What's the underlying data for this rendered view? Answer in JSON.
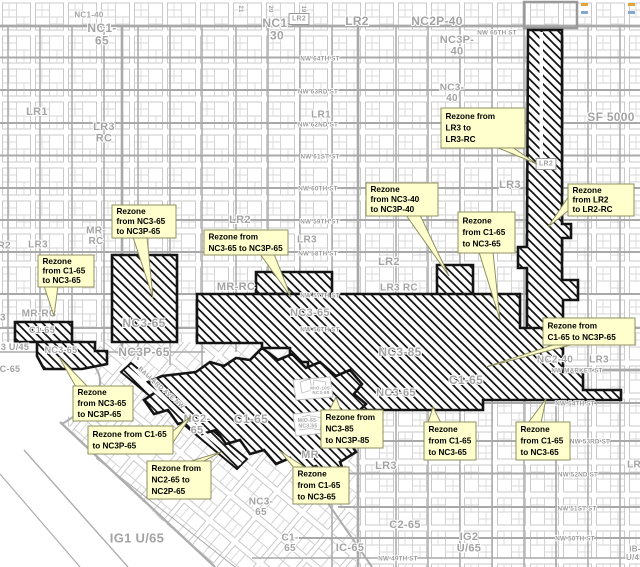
{
  "map": {
    "width": 640,
    "height": 567,
    "colors": {
      "background": "#ffffff",
      "parcel_line": "#cbcbcb",
      "street_line": "#a9a9a9",
      "zone_label": "#a3a3a3",
      "street_label": "#9b9b9b",
      "hatch_border": "#141414",
      "hatch_line": "#141414",
      "callout_bg": "#ffffcd",
      "callout_border": "#8f8f62",
      "callout_text": "#000000"
    }
  },
  "zone_labels": [
    {
      "text": "NC1-40",
      "x": 89,
      "y": 15,
      "size": 8
    },
    {
      "text": "NC1-\n65",
      "x": 102,
      "y": 28,
      "size": 12
    },
    {
      "text": "NC1-\n30",
      "x": 277,
      "y": 23,
      "size": 12
    },
    {
      "text": "LR2",
      "x": 299,
      "y": 19,
      "size": 7,
      "boxed": true
    },
    {
      "text": "LR2",
      "x": 357,
      "y": 21,
      "size": 12
    },
    {
      "text": "NC2P-40",
      "x": 437,
      "y": 21,
      "size": 12
    },
    {
      "text": "NC3P-\n40",
      "x": 457,
      "y": 40,
      "size": 11
    },
    {
      "text": "NC3-\n40",
      "x": 452,
      "y": 88,
      "size": 10
    },
    {
      "text": "LR1",
      "x": 37,
      "y": 112,
      "size": 11
    },
    {
      "text": "LR3\nRC",
      "x": 104,
      "y": 127,
      "size": 11
    },
    {
      "text": "LR1",
      "x": 321,
      "y": 115,
      "size": 10
    },
    {
      "text": "SF 5000",
      "x": 611,
      "y": 117,
      "size": 12
    },
    {
      "text": "LR2",
      "x": 240,
      "y": 220,
      "size": 11
    },
    {
      "text": "MR-\nRC",
      "x": 96,
      "y": 231,
      "size": 10
    },
    {
      "text": "LR3",
      "x": 38,
      "y": 245,
      "size": 10
    },
    {
      "text": "LR2",
      "x": 1,
      "y": 246,
      "size": 10
    },
    {
      "text": "LR3",
      "x": 307,
      "y": 240,
      "size": 10
    },
    {
      "text": "LR2",
      "x": 546,
      "y": 164,
      "size": 7,
      "boxed": true
    },
    {
      "text": "LR3",
      "x": 510,
      "y": 185,
      "size": 11
    },
    {
      "text": "LR2",
      "x": 389,
      "y": 262,
      "size": 11
    },
    {
      "text": "LR3 RC",
      "x": 399,
      "y": 288,
      "size": 10
    },
    {
      "text": "MR-RC",
      "x": 236,
      "y": 287,
      "size": 11
    },
    {
      "text": "MR-RC",
      "x": 39,
      "y": 314,
      "size": 10
    },
    {
      "text": "LR3",
      "x": -4,
      "y": 318,
      "size": 10
    },
    {
      "text": "C1-65",
      "x": 42,
      "y": 330,
      "size": 9
    },
    {
      "text": "3 U/45",
      "x": 15,
      "y": 347,
      "size": 9
    },
    {
      "text": "NC3-65",
      "x": 61,
      "y": 350,
      "size": 9
    },
    {
      "text": "C-65",
      "x": 10,
      "y": 369,
      "size": 9
    },
    {
      "text": "NC3-65",
      "x": 144,
      "y": 323,
      "size": 12
    },
    {
      "text": "NC3P-65",
      "x": 144,
      "y": 352,
      "size": 12
    },
    {
      "text": "NC3-65",
      "x": 310,
      "y": 313,
      "size": 11
    },
    {
      "text": "NC3-85",
      "x": 400,
      "y": 352,
      "size": 12
    },
    {
      "text": "NC3-65",
      "x": 396,
      "y": 393,
      "size": 11
    },
    {
      "text": "C1-65",
      "x": 466,
      "y": 380,
      "size": 12
    },
    {
      "text": "NC2-\n65",
      "x": 197,
      "y": 419,
      "size": 11
    },
    {
      "text": "C1-65",
      "x": 251,
      "y": 419,
      "size": 12
    },
    {
      "text": "MR",
      "x": 310,
      "y": 455,
      "size": 11
    },
    {
      "text": "NC2-40",
      "x": 555,
      "y": 360,
      "size": 10
    },
    {
      "text": "LR3",
      "x": 599,
      "y": 360,
      "size": 10
    },
    {
      "text": "LR3",
      "x": 386,
      "y": 466,
      "size": 11
    },
    {
      "text": "LR3",
      "x": 637,
      "y": 465,
      "size": 10
    },
    {
      "text": "NC3-\n65",
      "x": 261,
      "y": 502,
      "size": 10
    },
    {
      "text": "C1-\n65",
      "x": 290,
      "y": 538,
      "size": 10
    },
    {
      "text": "C2-65",
      "x": 405,
      "y": 525,
      "size": 11
    },
    {
      "text": "IC-65",
      "x": 350,
      "y": 548,
      "size": 11
    },
    {
      "text": "IG1 U/65",
      "x": 137,
      "y": 538,
      "size": 13
    },
    {
      "text": "IG2\nU/65",
      "x": 469,
      "y": 537,
      "size": 11
    },
    {
      "text": "IB-\nU/45",
      "x": 635,
      "y": 549,
      "size": 8
    },
    {
      "text": "MIO-105-\nNC3-65",
      "x": 321,
      "y": 388,
      "size": 4.5
    },
    {
      "text": "MIO-65-\nNC3-65",
      "x": 308,
      "y": 421,
      "size": 5
    }
  ],
  "street_labels": [
    {
      "text": "NW 65TH ST",
      "x": 497,
      "y": 33
    },
    {
      "text": "NW 64TH ST",
      "x": 320,
      "y": 59
    },
    {
      "text": "NW 63RD ST",
      "x": 318,
      "y": 92
    },
    {
      "text": "NW 62ND ST",
      "x": 318,
      "y": 125
    },
    {
      "text": "NW 61ST ST",
      "x": 320,
      "y": 157
    },
    {
      "text": "NW 60TH ST",
      "x": 318,
      "y": 189
    },
    {
      "text": "NW 59TH ST",
      "x": 320,
      "y": 222
    },
    {
      "text": "NW 58TH ST",
      "x": 318,
      "y": 254
    },
    {
      "text": "NW 57TH ST",
      "x": 320,
      "y": 296
    },
    {
      "text": "NW 56TH ST",
      "x": 320,
      "y": 330
    },
    {
      "text": "NW MARKET ST",
      "x": 577,
      "y": 371
    },
    {
      "text": "NW 54TH ST",
      "x": 575,
      "y": 404
    },
    {
      "text": "NW 53RD ST",
      "x": 590,
      "y": 442
    },
    {
      "text": "NW 52ND ST",
      "x": 578,
      "y": 475
    },
    {
      "text": "NW 51ST ST",
      "x": 577,
      "y": 509
    },
    {
      "text": "NW 50TH ST",
      "x": 575,
      "y": 539
    },
    {
      "text": "NW 49TH ST",
      "x": 398,
      "y": 559
    },
    {
      "text": "BALLARD AVE NW",
      "x": 161,
      "y": 388,
      "rotate": 42
    },
    {
      "text": "21",
      "x": 240,
      "y": 9,
      "rotate": 90,
      "size": 6
    },
    {
      "text": "20",
      "x": 270,
      "y": 9,
      "rotate": 90,
      "size": 6
    },
    {
      "text": "19",
      "x": 303,
      "y": 9,
      "rotate": 90,
      "size": 6
    }
  ],
  "callouts": [
    {
      "id": "lr3-to-lr3rc",
      "lines": [
        "Rezone from",
        "LR3 to",
        "LR3-RC"
      ],
      "x": 441,
      "y": 108,
      "w": 84,
      "h": 40,
      "tail": [
        496,
        147,
        512,
        147,
        537,
        164
      ]
    },
    {
      "id": "lr2-to-lr2rc",
      "lines": [
        "Rezone",
        "from LR2",
        "to LR2-RC"
      ],
      "x": 568,
      "y": 184,
      "w": 66,
      "h": 32,
      "tail": [
        569,
        196,
        569,
        210,
        548,
        227
      ]
    },
    {
      "id": "nc340-to-nc3p40",
      "lines": [
        "Rezone",
        "from NC3-40",
        "to NC3P-40"
      ],
      "x": 366,
      "y": 183,
      "w": 72,
      "h": 33,
      "tail": [
        406,
        215,
        420,
        215,
        449,
        276
      ]
    },
    {
      "id": "c165-to-nc365-r",
      "lines": [
        "Rezone",
        "from C1-65",
        "to NC3-65"
      ],
      "x": 458,
      "y": 212,
      "w": 57,
      "h": 41,
      "tail": [
        479,
        252,
        493,
        252,
        500,
        320
      ]
    },
    {
      "id": "nc365-to-nc3p65-a",
      "lines": [
        "Rezone",
        "from NC3-65",
        "to NC3P-65"
      ],
      "x": 112,
      "y": 205,
      "w": 64,
      "h": 33,
      "tail": [
        133,
        237,
        147,
        237,
        153,
        298
      ]
    },
    {
      "id": "nc365-to-nc3p65-b",
      "lines": [
        "Rezone from",
        "NC3-65 to NC3P-65"
      ],
      "x": 204,
      "y": 230,
      "w": 84,
      "h": 25,
      "tail": [
        260,
        254,
        274,
        254,
        291,
        297
      ]
    },
    {
      "id": "c165-to-nc365-l",
      "lines": [
        "Rezone",
        "from C1-65",
        "to NC3-65"
      ],
      "x": 38,
      "y": 255,
      "w": 56,
      "h": 32,
      "tail": [
        44,
        286,
        58,
        286,
        54,
        316
      ]
    },
    {
      "id": "c165-to-nc3p65-r",
      "lines": [
        "Rezone from",
        "C1-65 to NC3P-65"
      ],
      "x": 543,
      "y": 318,
      "w": 92,
      "h": 27,
      "tail": [
        556,
        344,
        574,
        344,
        486,
        367
      ]
    },
    {
      "id": "nc365-to-nc3p65-c",
      "lines": [
        "Rezone",
        "from NC3-65",
        "to NC3P-65"
      ],
      "x": 73,
      "y": 386,
      "w": 60,
      "h": 35,
      "tail": [
        76,
        387,
        88,
        387,
        59,
        357
      ]
    },
    {
      "id": "c165-to-nc3p65-b",
      "lines": [
        "Rezone from C1-65",
        "to NC3P-65"
      ],
      "x": 88,
      "y": 426,
      "w": 85,
      "h": 28,
      "tail": [
        172,
        432,
        172,
        444,
        191,
        416
      ]
    },
    {
      "id": "nc385-to-nc3p85",
      "lines": [
        "Rezone from",
        "NC3-85",
        "to NC3P-85"
      ],
      "x": 321,
      "y": 410,
      "w": 62,
      "h": 38,
      "tail": [
        329,
        411,
        341,
        411,
        336,
        397
      ]
    },
    {
      "id": "nc265-to-nc2p65",
      "lines": [
        "Rezone from",
        "NC2-65 to",
        "NC2P-65"
      ],
      "x": 147,
      "y": 461,
      "w": 64,
      "h": 38,
      "tail": [
        188,
        462,
        202,
        462,
        221,
        452
      ]
    },
    {
      "id": "c165-to-nc365-bm",
      "lines": [
        "Rezone",
        "from C1-65",
        "to NC3-65"
      ],
      "x": 293,
      "y": 467,
      "w": 56,
      "h": 37,
      "tail": [
        294,
        468,
        306,
        468,
        280,
        451
      ]
    },
    {
      "id": "c165-to-nc365-b1",
      "lines": [
        "Rezone",
        "from C1-65",
        "to NC3-65"
      ],
      "x": 424,
      "y": 422,
      "w": 52,
      "h": 38,
      "tail": [
        428,
        423,
        441,
        423,
        433,
        407
      ]
    },
    {
      "id": "c165-to-nc365-b2",
      "lines": [
        "Rezone",
        "from C1-65",
        "to NC3-65"
      ],
      "x": 516,
      "y": 422,
      "w": 54,
      "h": 38,
      "tail": [
        528,
        423,
        541,
        423,
        546,
        399
      ]
    }
  ],
  "rezone_areas": [
    {
      "id": "lr3-rc-column",
      "points": "528,30 562,30 562,224 571,224 571,238 562,238 562,280 578,280 578,300 563,300 563,341 546,341 546,354 527,354 527,268 518,268 518,247 527,247"
    },
    {
      "id": "band-57th-58th",
      "points": "256,272 332,272 332,294 256,294"
    },
    {
      "id": "square-57th",
      "points": "437,265 473,265 473,302 437,302"
    },
    {
      "id": "central-mass",
      "points": "197,294 520,294 520,328 563,328 563,372 583,372 583,390 621,390 621,400 483,400 483,410 345,410 345,393 330,393 330,375 308,375 308,362 290,362 290,348 262,348 262,343 197,343"
    },
    {
      "id": "nc365-rect",
      "points": "112,255 177,255 177,342 112,342"
    },
    {
      "id": "c165-box",
      "points": "15,322 72,322 72,342 15,342"
    },
    {
      "id": "nc365-left",
      "points": "37,342 95,342 95,351 107,351 107,364 82,369 44,369 37,356"
    },
    {
      "id": "ballard-strip-thin",
      "points": "121,372 131,363 247,459 237,469",
      "stroke_w": 2
    },
    {
      "id": "ballard-strip-main",
      "points": "196,372 210,362 224,366 236,358 250,360 262,348 278,360 292,354 306,368 320,362 336,376 350,370 362,384 354,394 366,404 354,416 362,428 348,440 356,452 340,462 344,472 328,478 316,466 302,472 290,458 276,464 264,450 250,454 240,440 226,444 216,430 202,434 192,420 178,424 168,410 154,414 144,400 156,392 148,382 162,376"
    }
  ],
  "mio_cutouts": [
    {
      "points": "293,380 330,377 333,397 296,400"
    },
    {
      "points": "293,414 322,411 325,433 296,436"
    }
  ],
  "ticks": [
    {
      "x": 581,
      "y": 3,
      "w": 7,
      "h": 3,
      "color": "#e2a23c"
    },
    {
      "x": 581,
      "y": 11,
      "w": 7,
      "h": 3,
      "color": "#86a8cf"
    },
    {
      "x": 628,
      "y": 3,
      "w": 7,
      "h": 3,
      "color": "#e2a23c"
    },
    {
      "x": 628,
      "y": 11,
      "w": 7,
      "h": 3,
      "color": "#86a8cf"
    }
  ]
}
